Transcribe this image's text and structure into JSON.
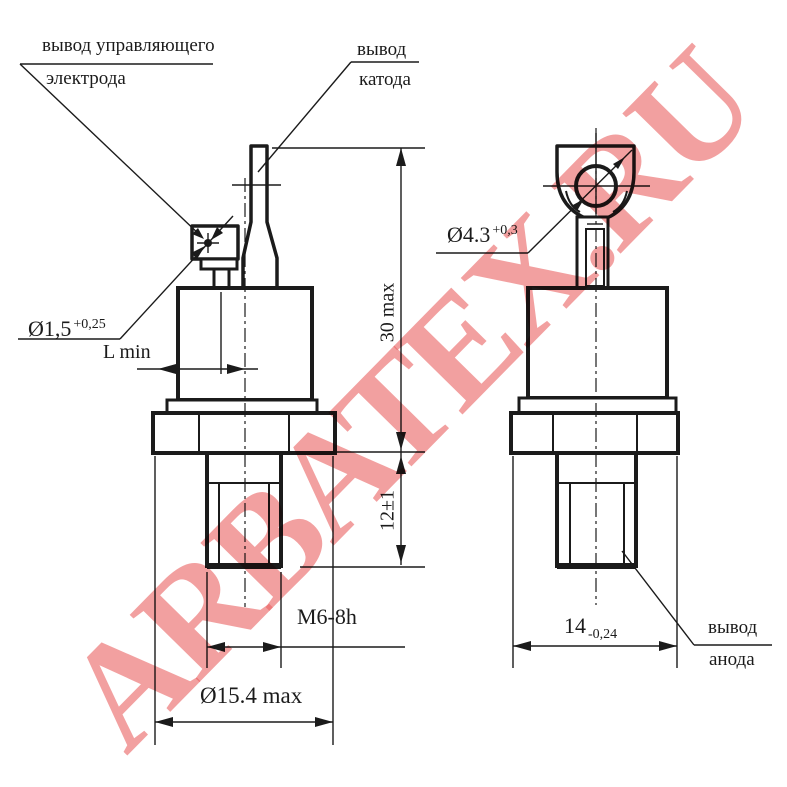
{
  "watermark": {
    "text": "ARBATEX.RU",
    "color": "#e96161"
  },
  "figure_left": {
    "gate_label_line1": "вывод управляющего",
    "gate_label_line2": "электрода",
    "cathode_label_line1": "вывод",
    "cathode_label_line2": "катода",
    "gate_hole_dia": "Ø1,5",
    "gate_hole_tol": "+0,25",
    "lead_offset": "L min",
    "overall_height": "30 max",
    "stud_length": "12±1",
    "thread": "M6-8h",
    "flange_dia": "Ø15.4 max"
  },
  "figure_right": {
    "ring_hole_dia": "Ø4.3",
    "ring_hole_tol": "+0,3",
    "across_flats": "14",
    "across_flats_tol": "-0,24",
    "anode_label_line1": "вывод",
    "anode_label_line2": "анода"
  }
}
